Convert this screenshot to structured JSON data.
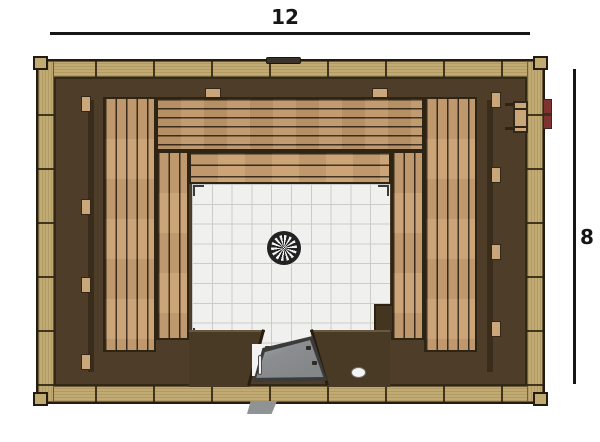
{
  "dimensions": {
    "width": {
      "label": "12"
    },
    "height": {
      "label": "8"
    }
  },
  "icons": {
    "drain": "pinwheel-drain-circle",
    "glass_door": "angled-open-parallelogram",
    "door_handle": "white-bar",
    "threshold_step": "gray-wedge",
    "door_knob": "white-oval",
    "roof_vent": "flat-dark-cap",
    "wall_vent": "slatted-plate",
    "red_fixture": "red-block"
  },
  "colors": {
    "background": "#ffffff",
    "line": "#161616",
    "outline": "#241c10",
    "frame-tan": "#c2ab72",
    "wall": "#4e3d29",
    "platform": "#483a24",
    "bench": "#c0976a",
    "bench-light": "#c9a173",
    "bench-gap": "#3b2d1c",
    "cleat": "#c9a77a",
    "tile": "#f0f0ee",
    "tile-grid": "#cbcbc8",
    "drain-dark": "#222222",
    "drain-light": "#f2f2f2",
    "glass": "#84878a",
    "glass-light": "#b0b3b5",
    "handle": "#eef0f1",
    "step-gray": "#909396",
    "knob": "#f4f4f2",
    "red": "#7d3431"
  }
}
